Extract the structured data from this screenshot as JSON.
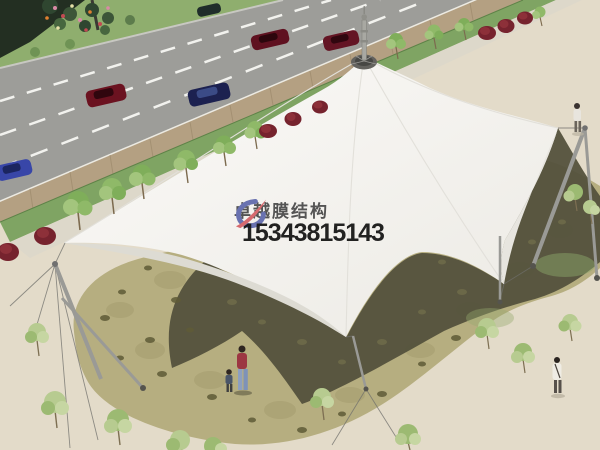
{
  "watermark": {
    "brand": "卓越膜结构",
    "phone": "15343815143",
    "brand_color": "#3f3f3f",
    "phone_color": "#171717",
    "logo_blue": "#5661a8",
    "logo_red": "#d2585e"
  },
  "scene_description": "Aerial 3D rendering of a white tensile membrane canopy structure on a beige plaza beside a multi-lane road with cars, sidewalk trees, red shrubs, flagstone paving, steel masts with cables, and a few pedestrians",
  "palette": {
    "plaza": "#e3dbc9",
    "road": "#9d9d99",
    "grass": "#8fae6e",
    "sidewalk": "#b4a082",
    "strip-green": "#7fa463",
    "walkway": "#ddd8ca",
    "stone": "#b6ae80",
    "shadow": "#53513b",
    "canopy": "#f6f5f1",
    "canopy-shade": "#dddbd3",
    "bush": "#76232e",
    "tree": "#9cba72",
    "hedge": "#232f22",
    "steel": "#9a9a96"
  }
}
